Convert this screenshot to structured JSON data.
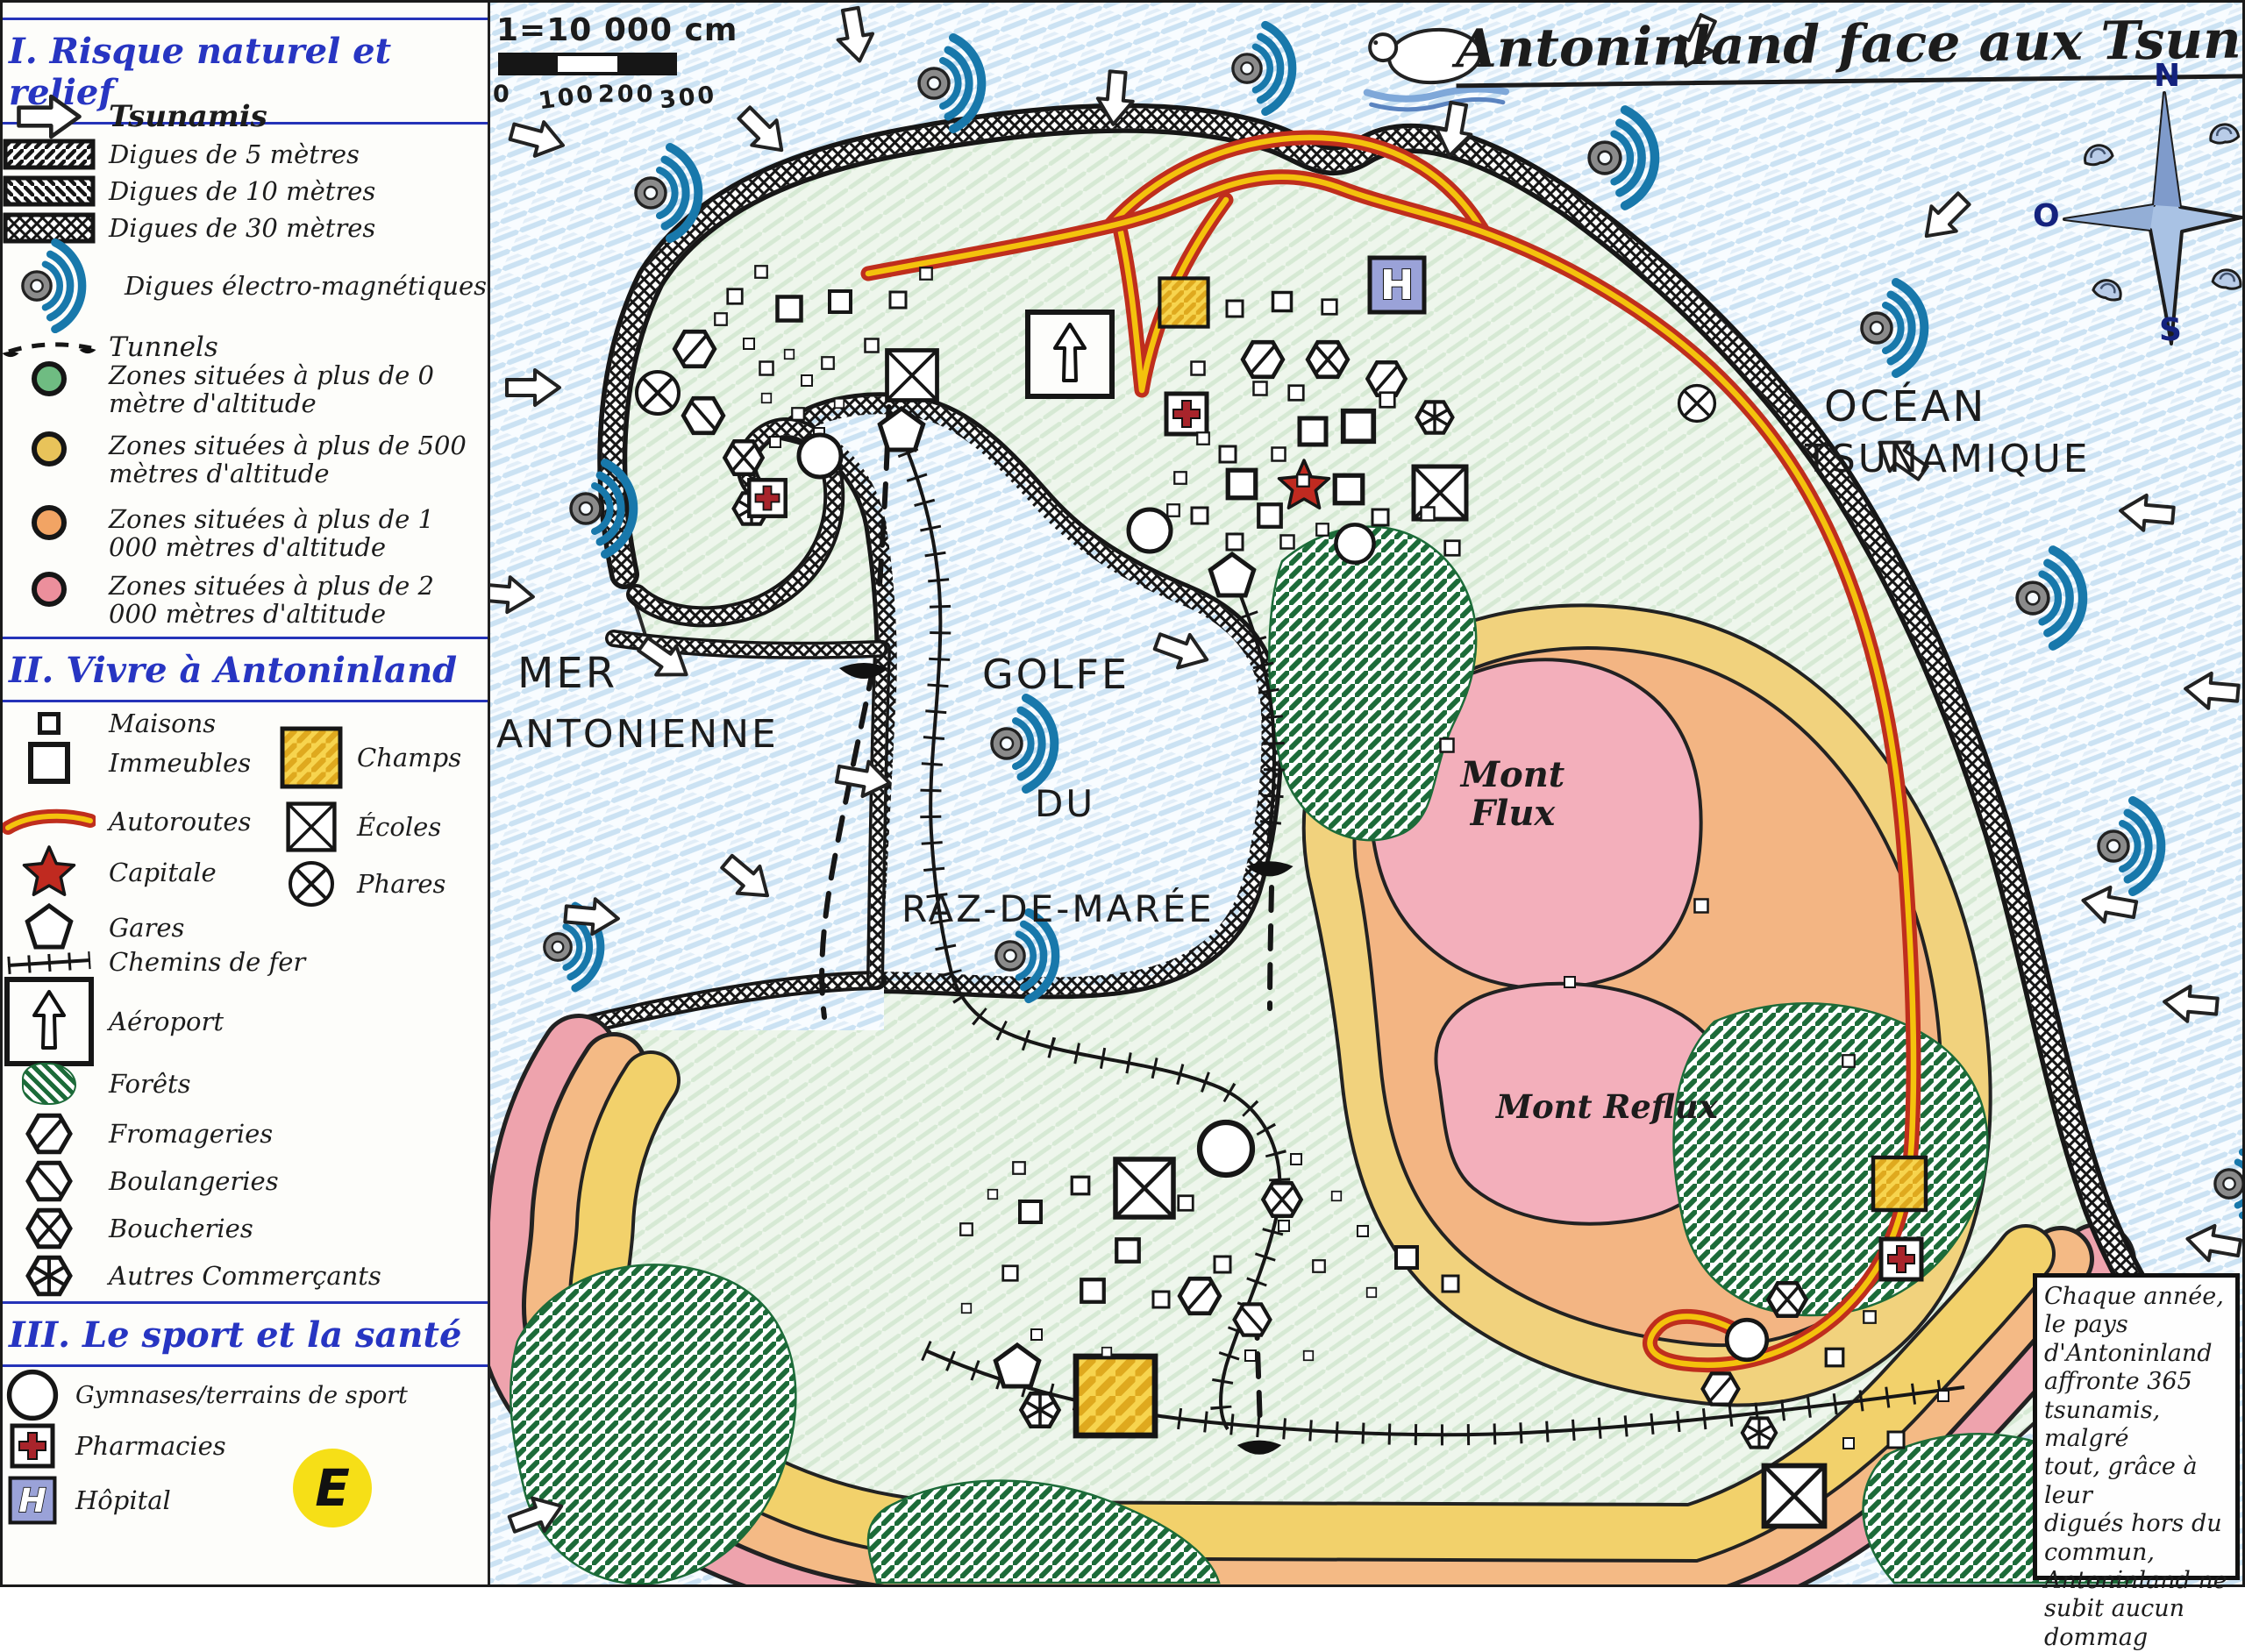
{
  "title": "Antoninland face aux Tsunamis",
  "scale": {
    "label": "1=10 000 cm",
    "ticks": [
      "0",
      "100",
      "200",
      "300"
    ]
  },
  "compass": {
    "north": "N",
    "west": "O",
    "south": "S"
  },
  "badge": "E",
  "legend": {
    "s1": {
      "heading": "I. Risque naturel et relief",
      "tsunamis": "Tsunamis",
      "items": [
        {
          "icon": "dike-5m-icon",
          "label": "Digues de 5 mètres"
        },
        {
          "icon": "dike-10m-icon",
          "label": "Digues de 10 mètres"
        },
        {
          "icon": "dike-30m-icon",
          "label": "Digues de 30 mètres"
        },
        {
          "icon": "electromagnetic-dike-icon",
          "label": "Digues électro-magnétiques"
        },
        {
          "icon": "tunnel-icon",
          "label": "Tunnels"
        },
        {
          "icon": "zone-green-icon",
          "label": "Zones situées à plus de 0 mètre d'altitude"
        },
        {
          "icon": "zone-yellow-icon",
          "label": "Zones situées à plus de 500 mètres d'altitude"
        },
        {
          "icon": "zone-orange-icon",
          "label": "Zones situées à plus de 1 000 mètres d'altitude"
        },
        {
          "icon": "zone-pink-icon",
          "label": "Zones situées à plus de 2 000 mètres d'altitude"
        }
      ]
    },
    "s2": {
      "heading": "II. Vivre à Antoninland",
      "left": [
        "Maisons",
        "Immeubles",
        "Autoroutes",
        "Capitale",
        "Gares",
        "Chemins de fer",
        "Aéroport",
        "Forêts",
        "Fromageries",
        "Boulangeries",
        "Boucheries",
        "Autres Commerçants"
      ],
      "right": [
        "Champs",
        "Écoles",
        "Phares"
      ]
    },
    "s3": {
      "heading": "III. Le sport et la santé",
      "items": [
        "Gymnases/terrains de sport",
        "Pharmacies",
        "Hôpital"
      ]
    }
  },
  "map_labels": {
    "sea_line1": "MER",
    "sea_line2": "ANTONIENNE",
    "gulf_line1": "GOLFE",
    "gulf_line2": "DU",
    "gulf_line3": "RAZ-DE-MARÉE",
    "ocean_line1": "OCÉAN",
    "ocean_line2": "TSUNAMIQUE",
    "mont_flux": "Mont Flux",
    "mont_reflux": "Mont Reflux"
  },
  "infobox": {
    "lines": [
      "Chaque année,",
      "le pays",
      "d'Antoninland",
      "affronte 365",
      "tsunamis, malgré",
      "tout, grâce à leur",
      "digués hors du",
      "commun,",
      "Antoninland ne",
      "subit aucun dommag"
    ]
  },
  "colors": {
    "wave_blue": "#1878ab",
    "highway_red": "#bf2e1d",
    "highway_yellow": "#f4c20d",
    "zone_green": "#6fbc82",
    "zone_yellow": "#e8c35a",
    "zone_orange": "#f2a464",
    "zone_pink": "#ec8f9c",
    "hospital_blue": "#9aa2d8",
    "cross_red": "#a8242b",
    "badge_yellow": "#f6df17"
  }
}
